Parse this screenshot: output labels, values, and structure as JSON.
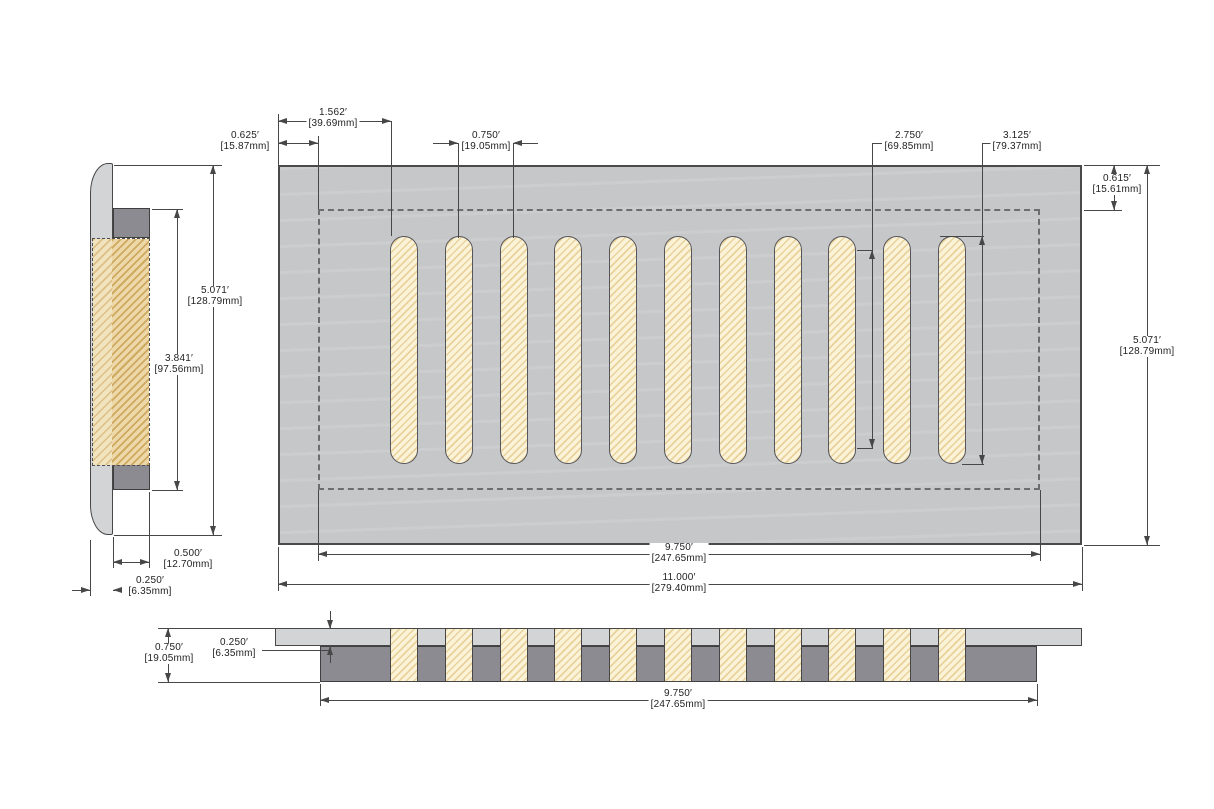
{
  "figure": {
    "type": "technical-drawing",
    "views": [
      "side-section-view",
      "front-view",
      "bottom-section-view"
    ],
    "slots": {
      "count": 11,
      "first_left": 390,
      "pitch": 54.8,
      "width": 28
    },
    "colors": {
      "panel_gray": "#c6c7c9",
      "faceplate_gray": "#d3d4d6",
      "dark_gray": "#8b8b91",
      "slot_fill": "#fbf3d7",
      "slot_hatch": "#e9d19b",
      "line": "#474747",
      "dashed": "#6d6d6d",
      "text": "#1f1f1f"
    }
  },
  "dims": {
    "d1562": {
      "in": "1.562′",
      "mm": "[39.69mm]"
    },
    "d0625": {
      "in": "0.625′",
      "mm": "[15.87mm]"
    },
    "d0750_top": {
      "in": "0.750′",
      "mm": "[19.05mm]"
    },
    "d2750": {
      "in": "2.750′",
      "mm": "[69.85mm]"
    },
    "d3125": {
      "in": "3.125′",
      "mm": "[79.37mm]"
    },
    "d0615": {
      "in": "0.615′",
      "mm": "[15.61mm]"
    },
    "d5071_right": {
      "in": "5.071′",
      "mm": "[128.79mm]"
    },
    "d9750_main": {
      "in": "9.750′",
      "mm": "[247.65mm]"
    },
    "d11000": {
      "in": "11.000′",
      "mm": "[279.40mm]"
    },
    "d5071_side": {
      "in": "5.071′",
      "mm": "[128.79mm]"
    },
    "d3841": {
      "in": "3.841′",
      "mm": "[97.56mm]"
    },
    "d0500": {
      "in": "0.500′",
      "mm": "[12.70mm]"
    },
    "d0250_side": {
      "in": "0.250′",
      "mm": "[6.35mm]"
    },
    "d0750_bottom": {
      "in": "0.750′",
      "mm": "[19.05mm]"
    },
    "d0250_bottom": {
      "in": "0.250′",
      "mm": "[6.35mm]"
    },
    "d9750_bottom": {
      "in": "9.750′",
      "mm": "[247.65mm]"
    }
  }
}
